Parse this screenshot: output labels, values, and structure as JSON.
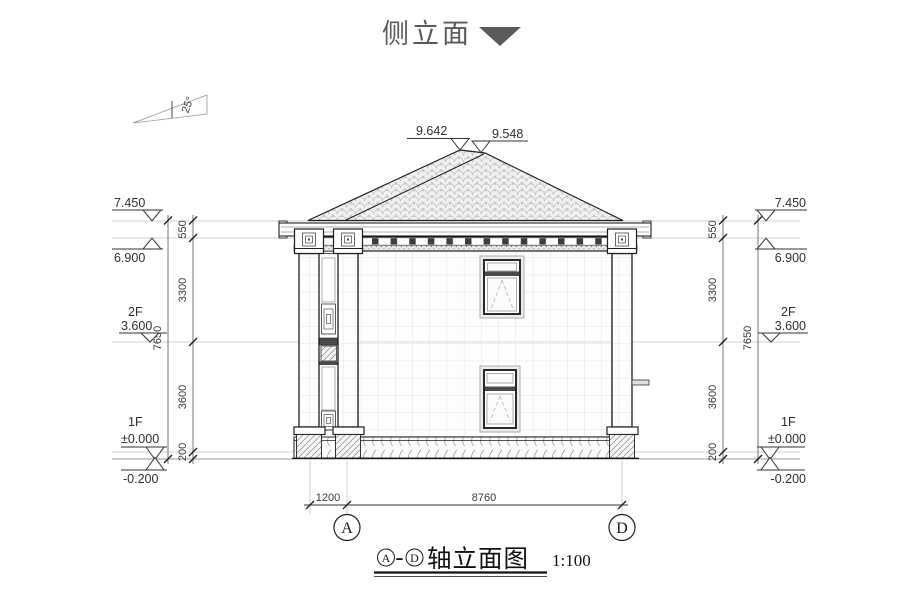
{
  "header": {
    "title": "侧立面"
  },
  "drawing": {
    "slope_label": "25°",
    "ridge": {
      "left": "9.642",
      "right": "9.548"
    },
    "levels": {
      "parapet_top": "7.450",
      "eave": "6.900",
      "floor2_tag": "2F",
      "floor2": "3.600",
      "floor1_tag": "1F",
      "floor1": "±0.000",
      "ground": "-0.200"
    },
    "vdims": {
      "parapet": "550",
      "story2": "3300",
      "story1": "3600",
      "plinth": "200",
      "total": "7650"
    },
    "hdims": {
      "porch": "1200",
      "span": "8760"
    },
    "axes": {
      "left": "A",
      "right": "D"
    }
  },
  "caption": {
    "axis_left": "A",
    "separator": "-",
    "axis_right": "D",
    "title": "轴立面图",
    "scale": "1:100"
  }
}
